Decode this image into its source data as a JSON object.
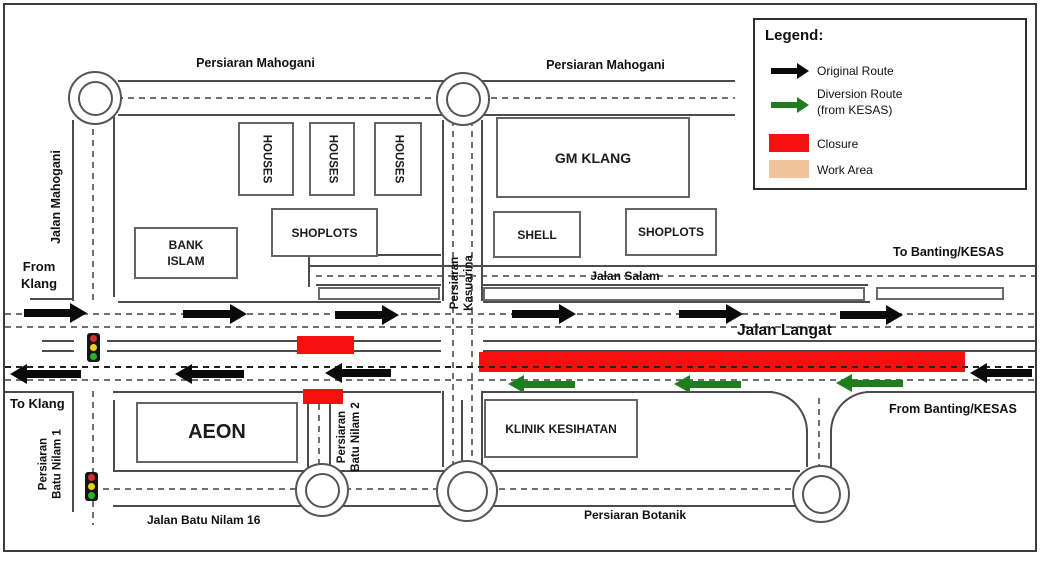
{
  "colors": {
    "original_route": "#0a0a0a",
    "diversion_route": "#1e7e1e",
    "closure": "#f50f0f",
    "work_area": "#f2c49c"
  },
  "legend": {
    "title": "Legend:",
    "original_route": "Original Route",
    "diversion_route_line1": "Diversion Route",
    "diversion_route_line2": "(from KESAS)",
    "closure": "Closure",
    "work_area": "Work Area"
  },
  "roads": {
    "persiaran_mahogani": "Persiaran Mahogani",
    "jalan_mahogani": "Jalan Mahogani",
    "kasuarina_1": "Persiaran",
    "kasuarina_2": "Kasuarina",
    "jalan_salam": "Jalan Salam",
    "jalan_langat": "Jalan Langat",
    "batu_nilam_1_l1": "Persiaran",
    "batu_nilam_1_l2": "Batu Nilam 1",
    "batu_nilam_2_l1": "Persiaran",
    "batu_nilam_2_l2": "Batu Nilam 2",
    "jalan_batu_nilam_16": "Jalan Batu Nilam 16",
    "persiaran_botanik": "Persiaran Botanik"
  },
  "directions": {
    "from_klang_line1": "From",
    "from_klang_line2": "Klang",
    "to_klang": "To Klang",
    "to_banting": "To Banting/KESAS",
    "from_banting": "From Banting/KESAS"
  },
  "buildings": {
    "houses": [
      "HOUSES",
      "HOUSES",
      "HOUSES"
    ],
    "gm_klang": "GM KLANG",
    "shoplots_left": "SHOPLOTS",
    "shoplots_right": "SHOPLOTS",
    "bank_islam_line1": "BANK",
    "bank_islam_line2": "ISLAM",
    "shell": "SHELL",
    "aeon": "AEON",
    "klinik_kesihatan": "KLINIK KESIHATAN"
  }
}
